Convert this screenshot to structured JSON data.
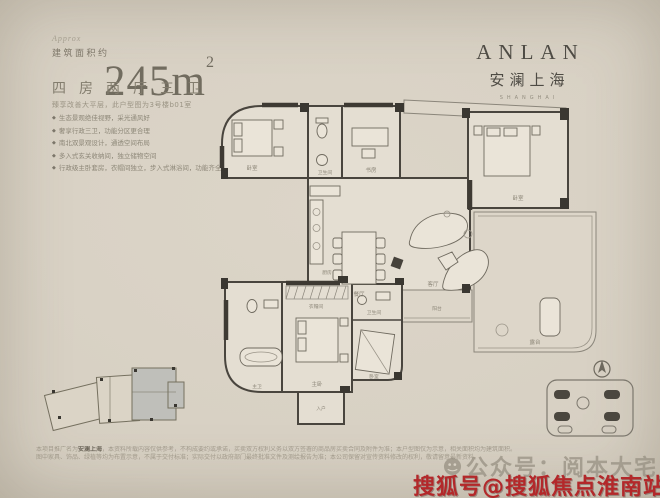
{
  "header": {
    "approx": "Approx",
    "area_label": "建筑面积约",
    "area_value": "245m",
    "area_sup": "2",
    "layout": "四房两厅三卫",
    "subtitle": "臻享改善大平层，此户型图为3号楼b01室",
    "features": [
      "生态景观绝佳视野，采光通风好",
      "奢享行政三卫，功能分区更合理",
      "南北双景观设计，通透空间布局",
      "多入式玄关收纳间，独立储物空间",
      "行政级主卧套房，衣帽间独立，步入式淋浴间，功能齐全"
    ],
    "bullet": "◆"
  },
  "brand": {
    "name": "ANLAN",
    "cn": "安澜上海",
    "en": "SHANGHAI"
  },
  "plan": {
    "rooms": {
      "bedroom1": "卧室",
      "bath1": "卫生间",
      "study": "书房",
      "bedroom2": "卧室",
      "kitchen": "厨房",
      "dining": "餐厅",
      "living": "客厅",
      "closet": "衣帽间",
      "master_bath": "主卫",
      "master": "主卧",
      "bath3": "卫生间",
      "bedroom3": "卧室",
      "balcony": "阳台",
      "terrace": "露台",
      "foyer": "入户"
    }
  },
  "footer": {
    "disclaimer_pre": "本项目推广名为",
    "disclaimer_bold": "安澜上海",
    "disclaimer_line1": "，本资料所载内容仅供参考，不构成要约或承诺，买卖双方权利义务以双方签署的商品房买卖合同及附件为准；本户型图仅为示意，相关面积均为建筑面积。",
    "disclaimer_line2": "图中家具、饰品、绿植等均为布置示意，不属于交付标准；实际交付以政府部门最终批准文件及测绘报告为准；本公司保留对宣传资料修改的权利，敬请留意最新资料。"
  },
  "watermarks": {
    "gray_label": "公众号：阅本大宅",
    "red_label": "搜狐号@搜狐焦点淮南站",
    "red_color": "#b3282a"
  }
}
